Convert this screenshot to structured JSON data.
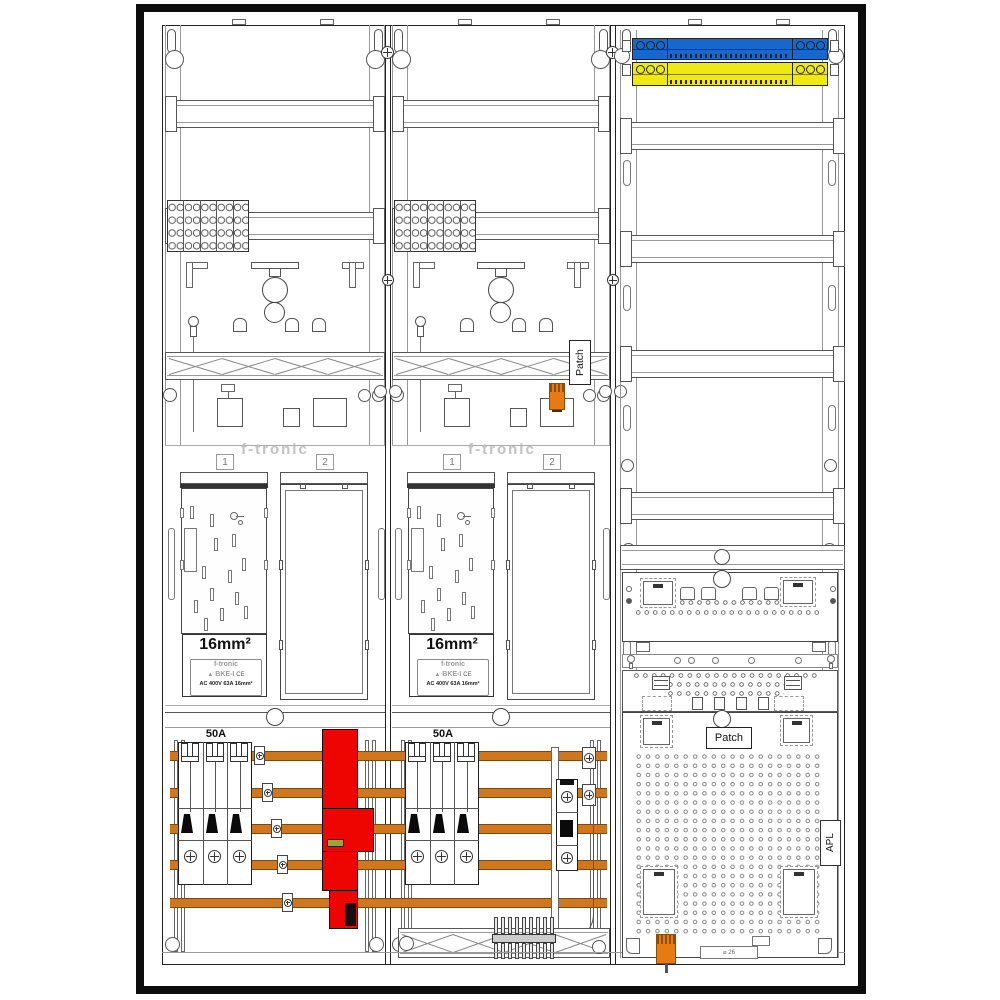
{
  "drawing": {
    "kind": "meter-cabinet wiring diagram",
    "fields": {
      "meter1": {
        "brand": "f-tronic",
        "slot1_label": "1",
        "slot2_label": "2",
        "bke_size": "16mm²",
        "plate": {
          "brand": "f-tronic",
          "model": "BKE-I",
          "ce_mark": "CE",
          "specs": "AC 400V   63A   16mm²"
        },
        "breaker_rating": "50A"
      },
      "meter2": {
        "brand": "f-tronic",
        "slot1_label": "1",
        "slot2_label": "2",
        "bke_size": "16mm²",
        "plate": {
          "brand": "f-tronic",
          "model": "BKE-I",
          "ce_mark": "CE",
          "specs": "AC 400V   63A   16mm²"
        },
        "breaker_rating": "50A",
        "patch_label": "Patch"
      },
      "multimedia": {
        "patch_label": "Patch",
        "apl_label": "APL",
        "gland_label": "⌀ 26"
      }
    }
  },
  "components": {
    "busbar_count": 5,
    "breaker_poles": 3,
    "rj45_ports": 4
  },
  "colors": {
    "busbar_orange": "#d0761c",
    "busbar_edge": "#7a4a12",
    "neutral_blue": "#1668cf",
    "pe_yellow": "#eeea10",
    "sls_red": "#ee0400",
    "led_green": "#93a83a",
    "connector_orange": "#e87a12",
    "connector_dark": "#8f4e08",
    "logo_gray": "#c2c2c2",
    "line_dark": "#333333",
    "line_light": "#949494"
  }
}
